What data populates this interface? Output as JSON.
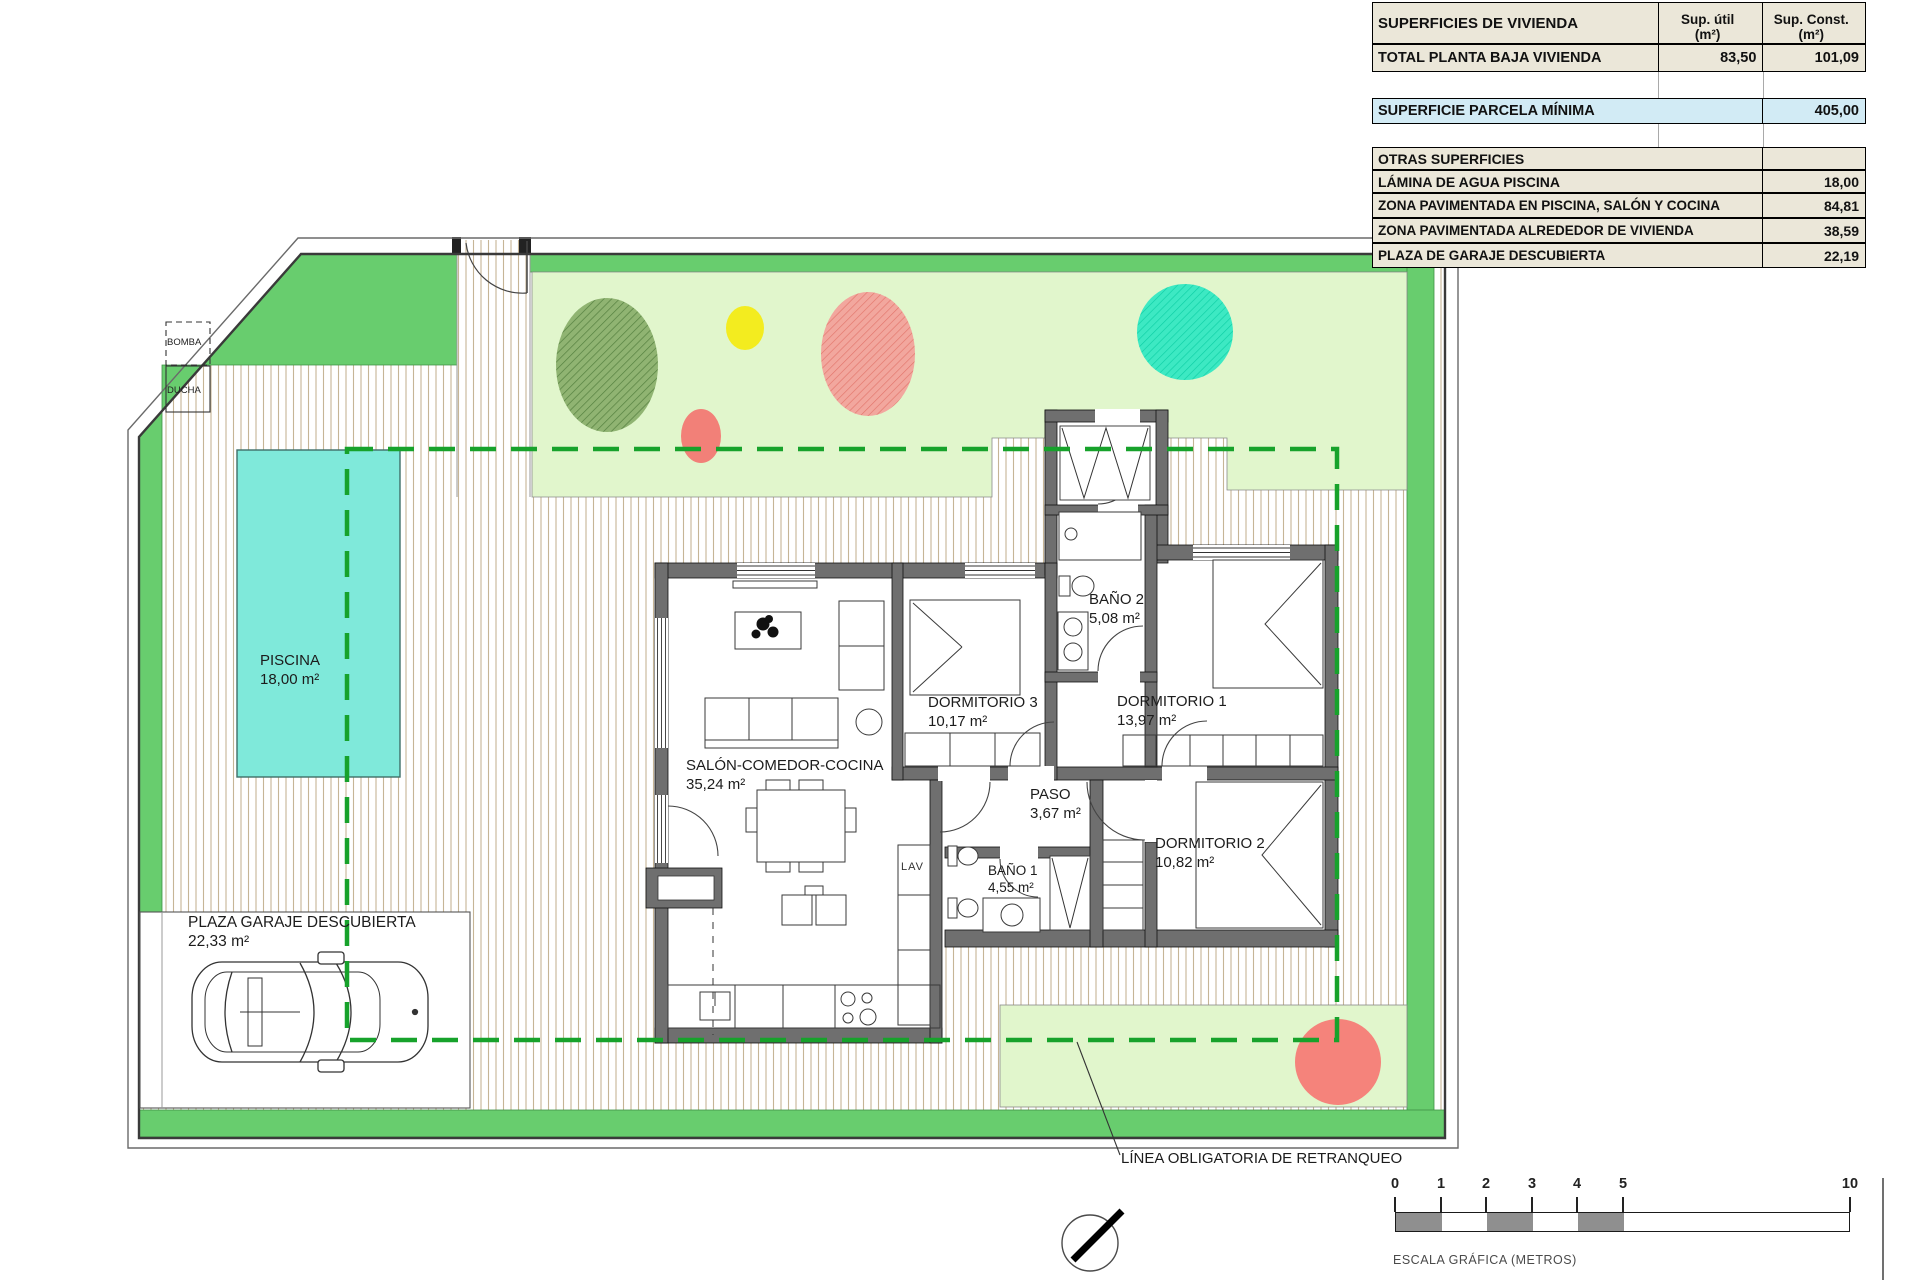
{
  "site": {
    "piscina": {
      "name": "PISCINA",
      "area": "18,00 m²"
    },
    "garaje": {
      "name": "PLAZA GARAJE DESCUBIERTA",
      "area": "22,33 m²"
    },
    "bomba": "BOMBA",
    "ducha": "DUCHA",
    "lav": "LAV",
    "setback_label": "LÍNEA OBLIGATORIA DE RETRANQUEO"
  },
  "rooms": {
    "salon": {
      "name": "SALÓN-COMEDOR-COCINA",
      "area": "35,24 m²"
    },
    "dorm3": {
      "name": "DORMITORIO 3",
      "area": "10,17 m²"
    },
    "bano2": {
      "name": "BAÑO 2",
      "area": "5,08 m²"
    },
    "dorm1": {
      "name": "DORMITORIO 1",
      "area": "13,97 m²"
    },
    "paso": {
      "name": "PASO",
      "area": "3,67 m²"
    },
    "bano1": {
      "name": "BAÑO 1",
      "area": "4,55 m²"
    },
    "dorm2": {
      "name": "DORMITORIO 2",
      "area": "10,82 m²"
    }
  },
  "summary_table": {
    "header": {
      "label": "SUPERFICIES DE VIVIENDA",
      "col_util": "Sup. útil",
      "col_const": "Sup. Const.",
      "unit": "(m²)"
    },
    "total": {
      "label": "TOTAL PLANTA BAJA VIVIENDA",
      "util": "83,50",
      "const": "101,09"
    },
    "parcela": {
      "label": "SUPERFICIE PARCELA MÍNIMA",
      "value": "405,00"
    },
    "otras_label": "OTRAS SUPERFICIES",
    "otras_rows": [
      {
        "label": "LÁMINA DE AGUA PISCINA",
        "value": "18,00"
      },
      {
        "label": "ZONA PAVIMENTADA EN PISCINA, SALÓN Y COCINA",
        "value": "84,81"
      },
      {
        "label": "ZONA PAVIMENTADA ALREDEDOR DE VIVIENDA",
        "value": "38,59"
      },
      {
        "label": "PLAZA DE GARAJE DESCUBIERTA",
        "value": "22,19"
      }
    ]
  },
  "scalebar": {
    "ticks": [
      "0",
      "1",
      "2",
      "3",
      "4",
      "5",
      "10"
    ],
    "caption": "ESCALA GRÁFICA (METROS)"
  },
  "colors": {
    "grass": "#68cd6e",
    "lawn": "#e1f6cc",
    "pool": "#7fe9da",
    "setback": "#17a22b",
    "wall": "#6f6f6f",
    "table_bg": "#ebe7d9",
    "table_highlight": "#d2ebf5"
  }
}
